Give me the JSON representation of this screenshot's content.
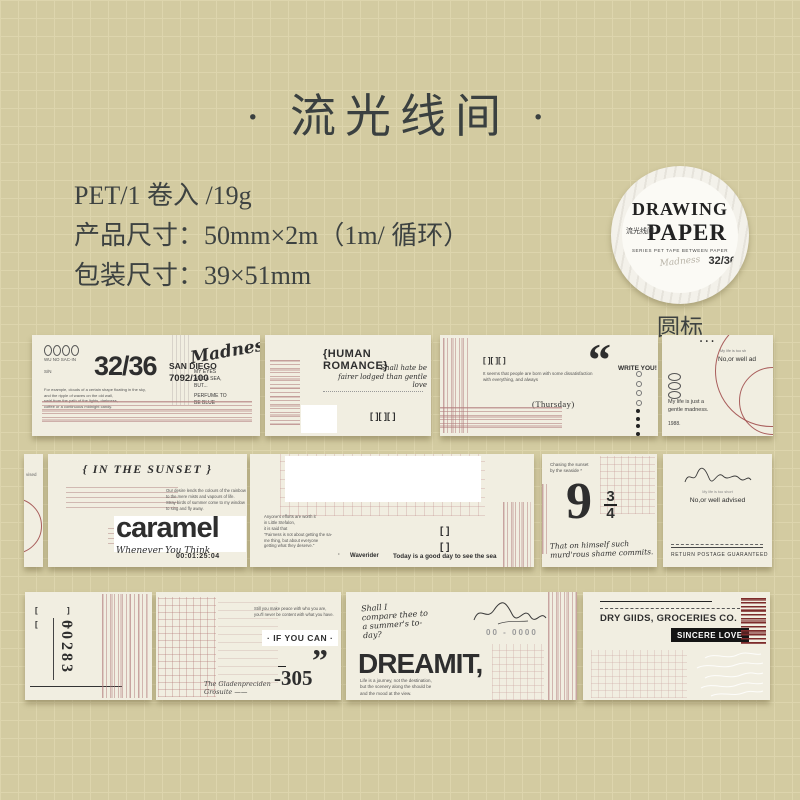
{
  "page": {
    "title": "· 流光线间 ·",
    "bg": "#d3cba1",
    "grid_line": "#ddd5ad",
    "accent_pink": "#c9a3a3",
    "accent_red": "#9c4444",
    "tape_cream": "#f1eee1"
  },
  "info": {
    "line1": "PET/1 卷入 /19g",
    "line2": "产品尺寸：50mm×2m（1m/ 循环）",
    "line3": "包装尺寸：39×51mm"
  },
  "badge": {
    "word1": "DRAWING",
    "word2": "PAPER",
    "cn": "流光线间",
    "series": "SERIES PET TAPE BETWEEN PAPER",
    "script": "Madness",
    "number": "32/36",
    "caption": "圆标"
  },
  "strip1": {
    "segA": {
      "serial_header": "WU NO SAC-IN",
      "sn": "S/N",
      "big_number": "32/36",
      "city": "SAN DIEGO",
      "code": "7092/100",
      "paragraph": "For example, clouds of a certain shape floating in the sky,\nand the ripple of waves on the old wall,\nswirl from the path of the lights, darkness,\ncoffee or a continuous midnight candy.",
      "script": "Madness",
      "note1": "MY EYES\nAND A SEA,\nBUT...",
      "note2": "PERFUME TO\nBE BLUE"
    },
    "segB": {
      "title": "{HUMAN ROMANCE}",
      "script1": "Shall hate be",
      "script2": "fairer lodged than gentle love",
      "brackets": "[ ][ ][ ]"
    },
    "segC": {
      "brackets": "[ ][ ][ ]",
      "text": "It seems that people are born with some dissatisfaction\nwith everything, and always",
      "day": "(Thursday)",
      "quote": "“",
      "write_you": "WRITE YOU!"
    },
    "segD": {
      "dots": "• • •",
      "tiny": "My life is too sh",
      "advised": "No,or well ad",
      "madness": "My life is just a\ngentle madness.",
      "year": "1988."
    }
  },
  "strip2": {
    "segP": {
      "text": "vised"
    },
    "segA": {
      "title": "{ IN THE SUNSET }",
      "paragraph": "Our desire lends the colours of the rainbow\nto the mere mists and vapours of life.\nStray birds of summer come to my window\nto sing and fly away.",
      "brand": "caramel",
      "sub": "Whenever You Think",
      "timecode": "00:01:25:04"
    },
    "segB": {
      "paragraph": "Anyone's efforts are worth it\nin Little Stefalon,\nit is said that\n\"Fairness is not about getting the sa-\nme thing, but about everyone\ngetting what they deserve.\"",
      "bullet": "·",
      "waverider": "Waverider",
      "slogan": "Today is a good day to see the sea",
      "bracket1": "[  ]",
      "bracket2": "[  ]"
    },
    "segC": {
      "tiny": "Chasing the sunset\nby the seaside *",
      "nine": "9",
      "frac_top": "3",
      "frac_bottom": "4",
      "script": "That on himself such\nmurd'rous shame commits."
    },
    "segD": {
      "tiny": "My life is too short",
      "advised": "No,or well advised",
      "footer": "RETURN POSTAGE GUARANTEED"
    }
  },
  "strip3": {
    "segA": {
      "number": "00283"
    },
    "segB": {
      "tiny": "Still you make peace with who you are,\nyou'll never be content with what you have.",
      "ifyoucan": "· IF YOU CAN ·",
      "quote": "”",
      "script": "The Gladenpreciden\nGrosuite ——",
      "number": "-305"
    },
    "segC": {
      "script": "Shall I\ncompare thee to\na summer's to-\nday?",
      "dreamit": "DREAMIT,",
      "paragraph": "Life is a journey, not the destination,\nbut the scenery along the should be\nand the mood at the view.",
      "code": "00 - 0000"
    },
    "segD": {
      "store": "DRY GIIDS, GROCERIES CO.",
      "love": "SINCERE LOVE"
    }
  }
}
